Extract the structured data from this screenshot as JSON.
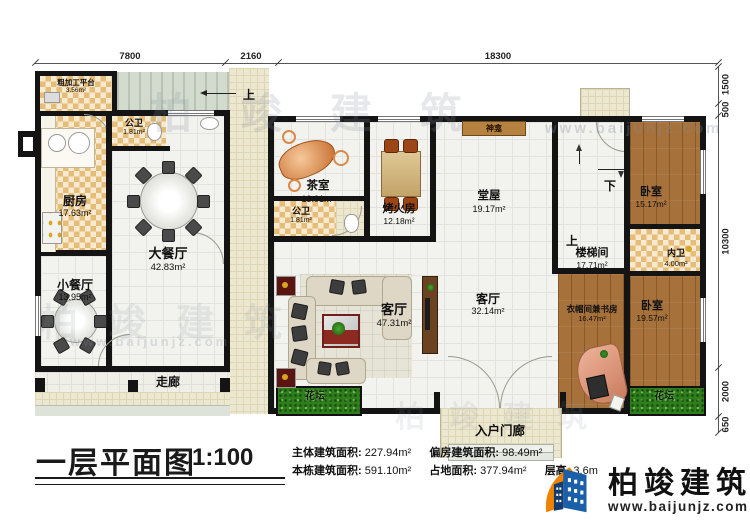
{
  "title_block": {
    "title": "一层平面图",
    "scale": "1:100",
    "stats": [
      {
        "label": "主体建筑面积:",
        "value": "227.94m²"
      },
      {
        "label": "偏房建筑面积:",
        "value": "98.49m²"
      },
      {
        "label": "本栋建筑面积:",
        "value": "591.10m²"
      },
      {
        "label": "占地面积:",
        "value": "377.94m²"
      },
      {
        "label": "层高:",
        "value": "3.6m"
      }
    ]
  },
  "brand": {
    "name": "柏竣建筑",
    "website": "www.baijunjz.com"
  },
  "watermark": {
    "text": "柏竣建筑",
    "site": "www.baijunjz.com"
  },
  "dims": {
    "top": [
      "7800",
      "2160",
      "18300"
    ],
    "right": [
      "1500",
      "500",
      "10300",
      "2000",
      "650"
    ]
  },
  "nav": {
    "up_outdoor": "上",
    "up_stair": "上",
    "down": "下"
  },
  "rooms": {
    "rough_platform": {
      "name": "粗加工平台",
      "area": "3.56m²"
    },
    "wc_left": {
      "name": "公卫",
      "area": "1.81m²"
    },
    "kitchen": {
      "name": "厨房",
      "area": "17.63m²"
    },
    "large_dining": {
      "name": "大餐厅",
      "area": "42.83m²"
    },
    "small_dining": {
      "name": "小餐厅",
      "area": "13.95m²"
    },
    "corridor": {
      "name": "走廊"
    },
    "tea_room": {
      "name": "茶室",
      "area": "13.01m²"
    },
    "wc_mid": {
      "name": "公卫",
      "area": "1.81m²"
    },
    "fire_room": {
      "name": "烤火房",
      "area": "12.18m²"
    },
    "hall": {
      "name": "堂屋",
      "area": "19.17m²"
    },
    "shrine": {
      "name": "神龛"
    },
    "stairwell": {
      "name": "楼梯间",
      "area": "17.71m²"
    },
    "bedroom_top": {
      "name": "卧室",
      "area": "15.17m²"
    },
    "inner_wc": {
      "name": "内卫",
      "area": "4.00m²"
    },
    "living_left": {
      "name": "客厅",
      "area": "47.31m²"
    },
    "living_mid": {
      "name": "客厅",
      "area": "32.14m²"
    },
    "cloak_study": {
      "name": "衣帽间兼书房",
      "area": "16.47m²"
    },
    "bedroom_bottom": {
      "name": "卧室",
      "area": "19.57m²"
    },
    "flowerbed_left": {
      "name": "花坛"
    },
    "flowerbed_right": {
      "name": "花坛"
    },
    "entry_porch": {
      "name": "入户门廊"
    }
  }
}
